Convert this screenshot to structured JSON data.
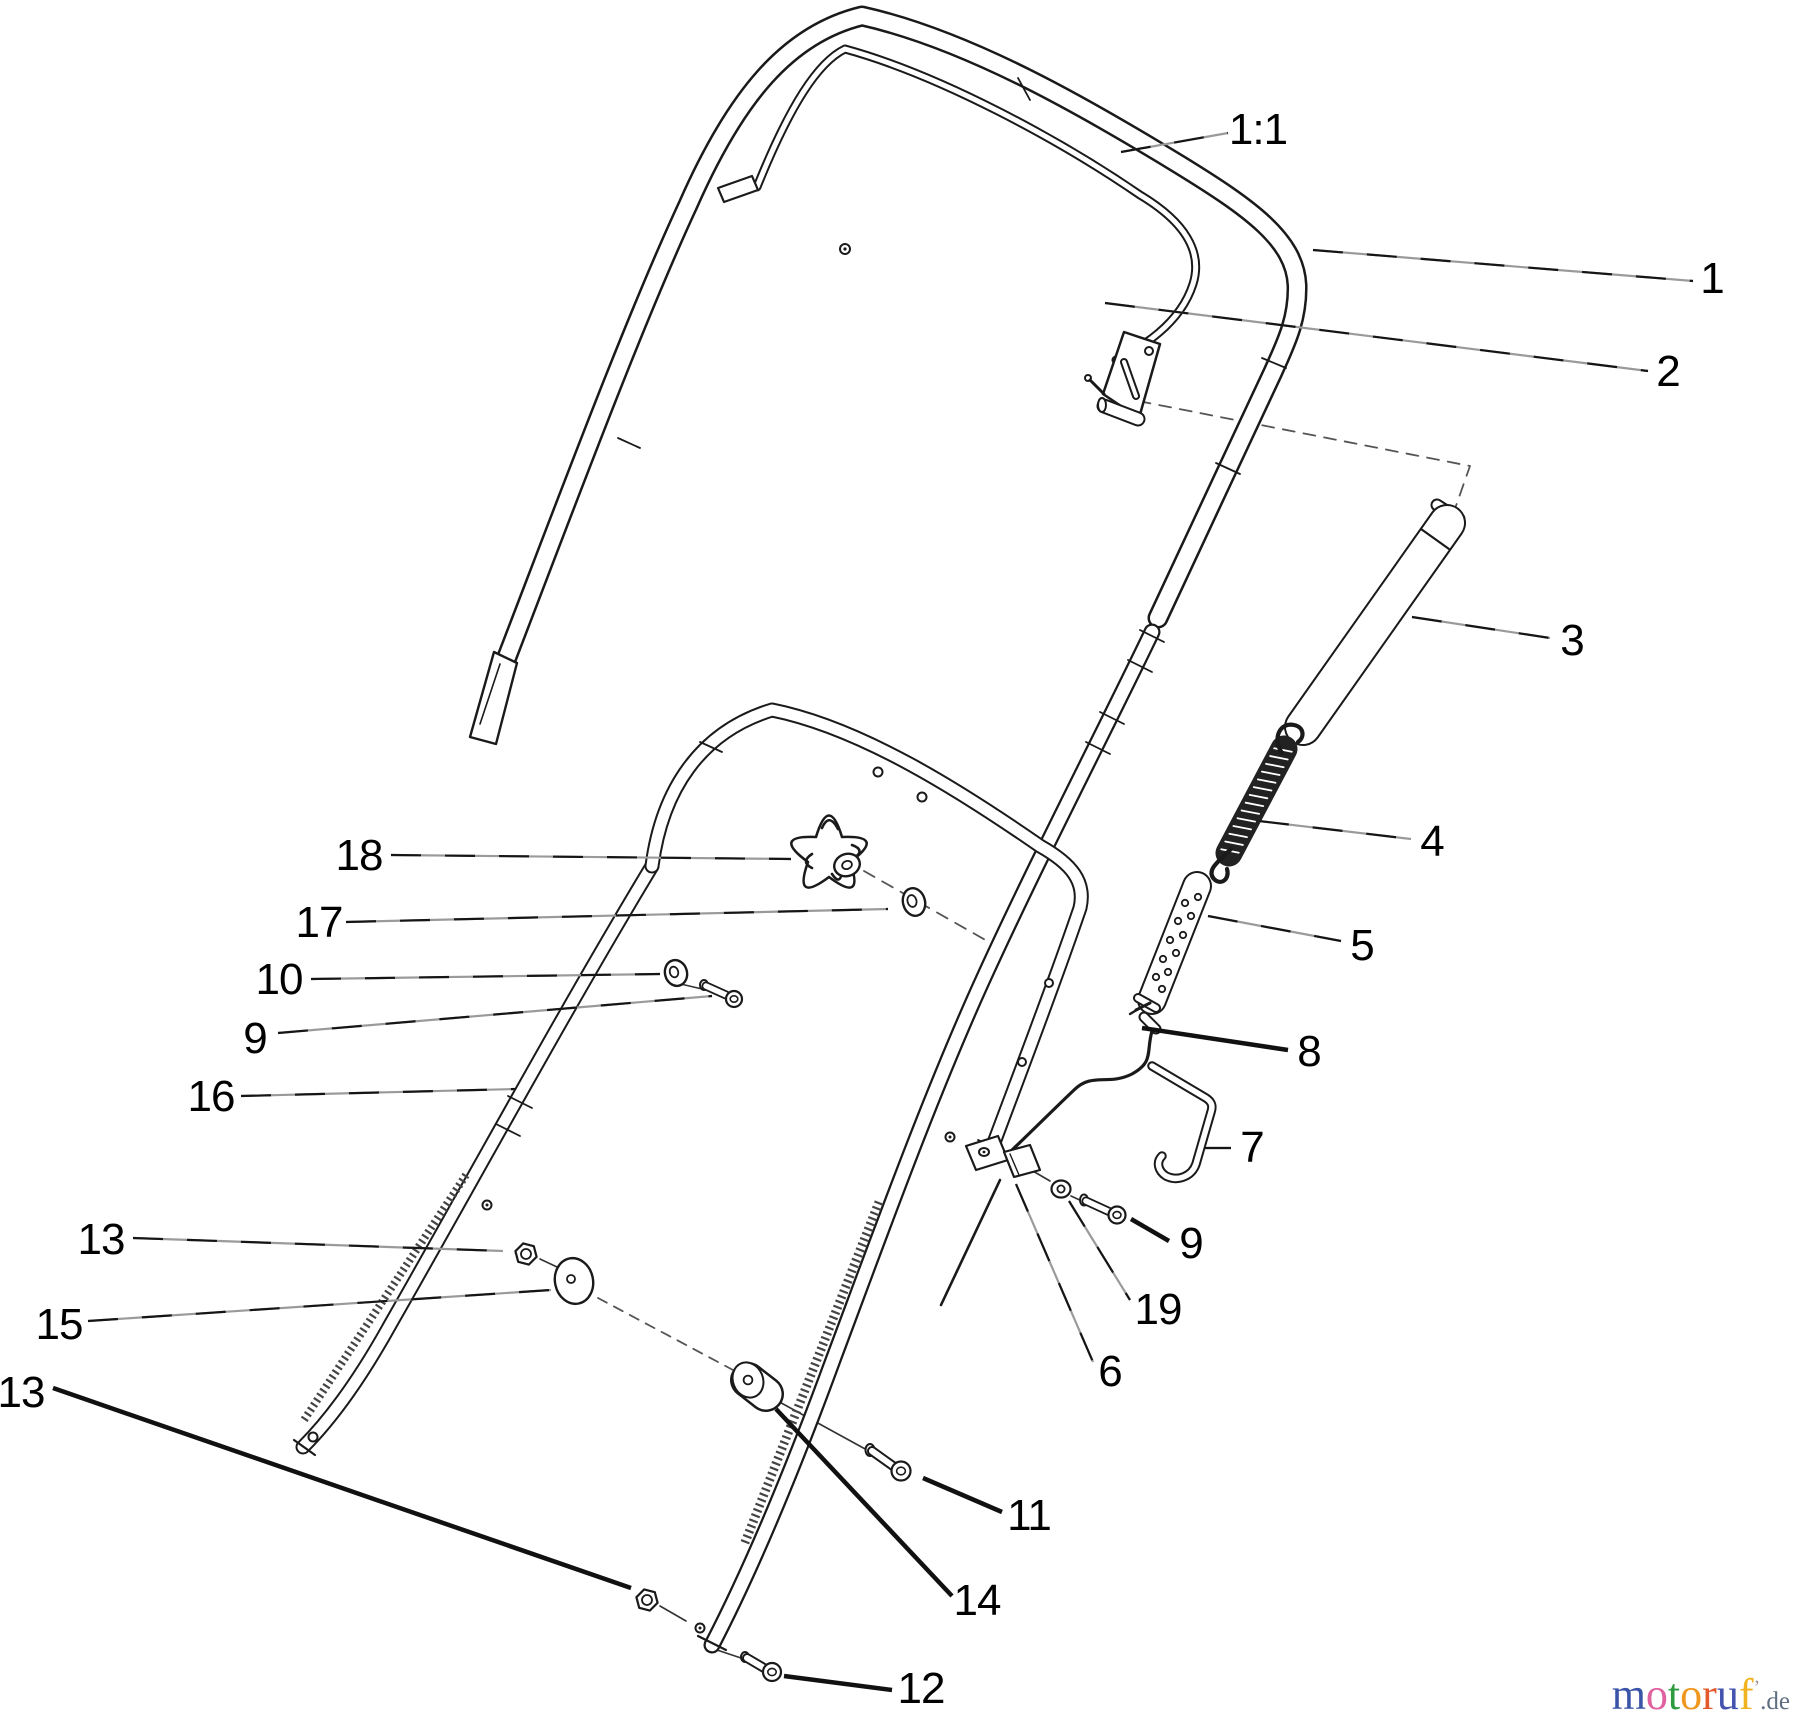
{
  "page": {
    "background": "#ffffff",
    "line_color": "#1a1a1a"
  },
  "diagram": {
    "type": "exploded-parts-diagram",
    "subject": "handle assembly line drawing",
    "callouts": [
      {
        "id": "scale-note",
        "label": "1:1",
        "x": 1258,
        "y": 130,
        "x1": 1121,
        "y1": 152,
        "x2": 1228,
        "y2": 133,
        "style": "thin"
      },
      {
        "id": "part-1",
        "label": "1",
        "x": 1712,
        "y": 279,
        "x1": 1313,
        "y1": 250,
        "x2": 1693,
        "y2": 281,
        "style": "thin"
      },
      {
        "id": "part-2",
        "label": "2",
        "x": 1668,
        "y": 372,
        "x1": 1105,
        "y1": 303,
        "x2": 1648,
        "y2": 371,
        "style": "thin"
      },
      {
        "id": "part-3",
        "label": "3",
        "x": 1572,
        "y": 641,
        "x1": 1412,
        "y1": 617,
        "x2": 1550,
        "y2": 638,
        "style": "thin"
      },
      {
        "id": "part-4",
        "label": "4",
        "x": 1432,
        "y": 842,
        "x1": 1259,
        "y1": 821,
        "x2": 1411,
        "y2": 839,
        "style": "thin"
      },
      {
        "id": "part-5",
        "label": "5",
        "x": 1362,
        "y": 946,
        "x1": 1208,
        "y1": 916,
        "x2": 1341,
        "y2": 941,
        "style": "thin"
      },
      {
        "id": "part-8",
        "label": "8",
        "x": 1309,
        "y": 1052,
        "x1": 1142,
        "y1": 1028,
        "x2": 1288,
        "y2": 1050,
        "style": "bold"
      },
      {
        "id": "part-7",
        "label": "7",
        "x": 1252,
        "y": 1148,
        "x1": 1204,
        "y1": 1148,
        "x2": 1231,
        "y2": 1148,
        "style": "thin"
      },
      {
        "id": "part-9-right",
        "label": "9",
        "x": 1191,
        "y": 1244,
        "x1": 1131,
        "y1": 1219,
        "x2": 1169,
        "y2": 1241,
        "style": "bold"
      },
      {
        "id": "part-19",
        "label": "19",
        "x": 1158,
        "y": 1310,
        "x1": 1069,
        "y1": 1201,
        "x2": 1130,
        "y2": 1300,
        "style": "thin"
      },
      {
        "id": "part-6",
        "label": "6",
        "x": 1110,
        "y": 1372,
        "x1": 1016,
        "y1": 1184,
        "x2": 1093,
        "y2": 1362,
        "style": "thin"
      },
      {
        "id": "part-11",
        "label": "11",
        "x": 1029,
        "y": 1516,
        "x1": 923,
        "y1": 1478,
        "x2": 1002,
        "y2": 1512,
        "style": "bold"
      },
      {
        "id": "part-14",
        "label": "14",
        "x": 977,
        "y": 1601,
        "x1": 776,
        "y1": 1409,
        "x2": 952,
        "y2": 1596,
        "style": "bold"
      },
      {
        "id": "part-12",
        "label": "12",
        "x": 921,
        "y": 1689,
        "x1": 784,
        "y1": 1676,
        "x2": 892,
        "y2": 1690,
        "style": "bold"
      },
      {
        "id": "part-18",
        "label": "18",
        "x": 359,
        "y": 856,
        "x1": 391,
        "y1": 855,
        "x2": 791,
        "y2": 859,
        "style": "thin"
      },
      {
        "id": "part-17",
        "label": "17",
        "x": 319,
        "y": 923,
        "x1": 346,
        "y1": 922,
        "x2": 888,
        "y2": 909,
        "style": "thin"
      },
      {
        "id": "part-10",
        "label": "10",
        "x": 279,
        "y": 980,
        "x1": 311,
        "y1": 979,
        "x2": 660,
        "y2": 974,
        "style": "thin"
      },
      {
        "id": "part-9-left",
        "label": "9",
        "x": 255,
        "y": 1039,
        "x1": 278,
        "y1": 1033,
        "x2": 712,
        "y2": 996,
        "style": "thin"
      },
      {
        "id": "part-16",
        "label": "16",
        "x": 211,
        "y": 1097,
        "x1": 241,
        "y1": 1096,
        "x2": 516,
        "y2": 1089,
        "style": "thin"
      },
      {
        "id": "part-13-upper",
        "label": "13",
        "x": 101,
        "y": 1240,
        "x1": 133,
        "y1": 1238,
        "x2": 503,
        "y2": 1251,
        "style": "thin"
      },
      {
        "id": "part-15",
        "label": "15",
        "x": 59,
        "y": 1325,
        "x1": 88,
        "y1": 1321,
        "x2": 551,
        "y2": 1290,
        "style": "thin"
      },
      {
        "id": "part-13-lower",
        "label": "13",
        "x": 21,
        "y": 1393,
        "x1": 53,
        "y1": 1388,
        "x2": 631,
        "y2": 1588,
        "style": "bold"
      }
    ],
    "watermark": {
      "letters": [
        {
          "ch": "m",
          "color": "#3a55a8"
        },
        {
          "ch": "o",
          "color": "#e0619f"
        },
        {
          "ch": "t",
          "color": "#2e9b3e"
        },
        {
          "ch": "o",
          "color": "#f0971f"
        },
        {
          "ch": "r",
          "color": "#e2592b"
        },
        {
          "ch": "u",
          "color": "#4353ae"
        },
        {
          "ch": "f",
          "color": "#f0b31f"
        }
      ],
      "tick": "’",
      "suffix": ".de"
    }
  }
}
